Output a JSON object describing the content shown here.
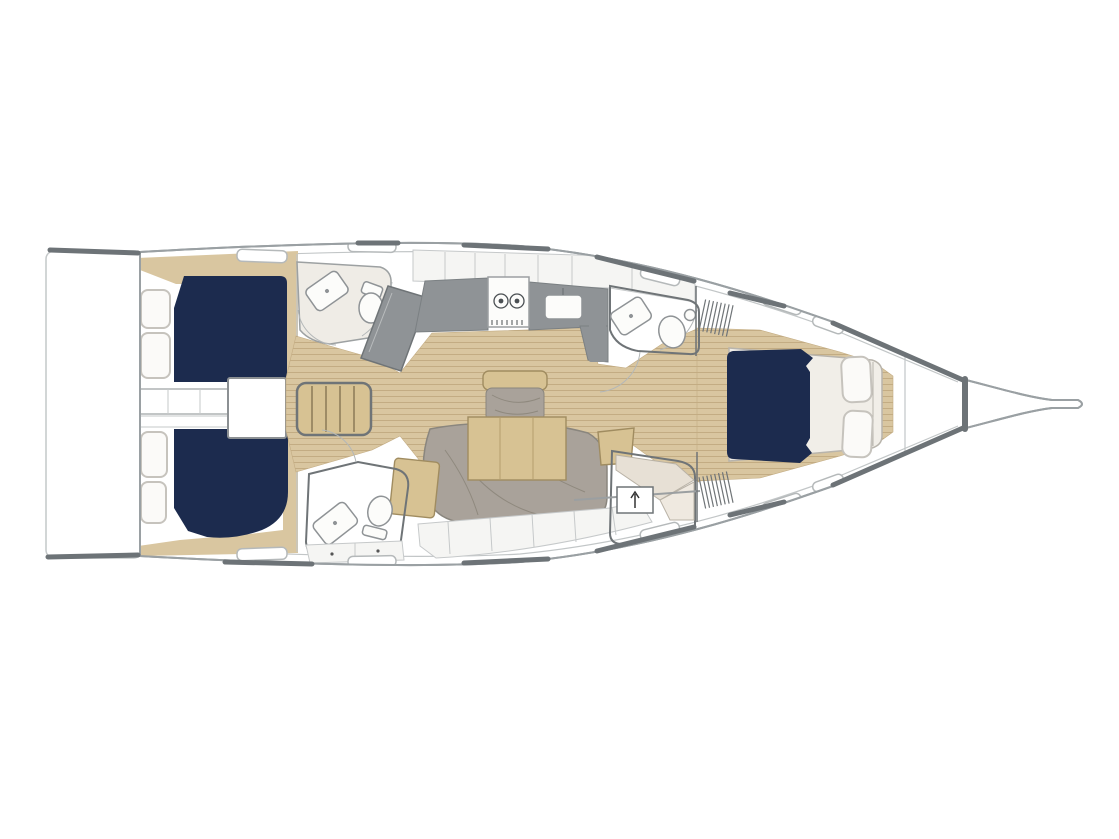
{
  "page": {
    "background": "#ffffff",
    "width": 1119,
    "height": 839
  },
  "diagram": {
    "type": "sailing-yacht-interior-floor-plan",
    "view": "top-down",
    "orientation": "bow-right",
    "text_labels": [],
    "regions": [
      "swim-platform",
      "port-aft-cabin",
      "starboard-aft-cabin",
      "companionway-steps",
      "engine-box",
      "port-aft-head",
      "starboard-aft-head",
      "galley",
      "salon",
      "salon-table",
      "salon-sofa",
      "forward-head",
      "forward-cabin",
      "bow"
    ],
    "fixtures": [
      "double-berth",
      "pillow",
      "stove-two-burner",
      "sink",
      "washbasin",
      "toilet",
      "wardrobe",
      "settee",
      "chaise-lounge",
      "vent-grill",
      "hull-window",
      "locker"
    ]
  },
  "colors": {
    "background": "#ffffff",
    "hull_outline": "#9aa0a3",
    "toe_rail": "#6d7377",
    "berth_navy": "#1c2b4e",
    "wood_floor": "#d9c6a0",
    "wood_plank_line": "#c3ac83",
    "counter_gray": "#8f9396",
    "furniture_tan": "#d7c293",
    "cushion_gray": "#a9a29a",
    "room_cream": "#efece6",
    "compartment_cream": "#f3f1ed",
    "cushion_beige": "#e7e0d5",
    "fixture_white": "#fcfcfa",
    "pillow_white": "#fbfaf8",
    "outline_dark": "#6f7477",
    "outline_light": "#c6c9ca"
  }
}
